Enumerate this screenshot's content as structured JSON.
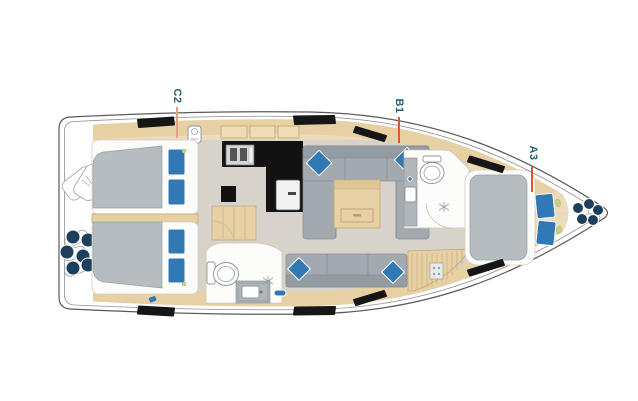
{
  "page": {
    "background": "#ffffff"
  },
  "labels": [
    {
      "text": "C2",
      "leader": "warm"
    },
    {
      "text": "B1",
      "leader": "red"
    },
    {
      "text": "A3",
      "leader": "red"
    }
  ],
  "icons": [
    "life-raft-icon",
    "stern-fenders-icon",
    "bow-fenders-icon",
    "stove-icon",
    "fridge-icon",
    "steps-icon",
    "toilet-icon",
    "sink-icon",
    "shower-icon",
    "table-icon",
    "deck-hatch-icon",
    "reading-light-icon"
  ],
  "colors": {
    "label_text": "#1f5e70",
    "leader_warm": "#e0a285",
    "leader_red": "#d8583a",
    "hull_line": "#5a5a5a",
    "wood_base": "#eddcbb",
    "wood_trim": "#e6d0a4",
    "wood_edge": "#c2a878",
    "floor_gray": "#d8d3ca",
    "upholstery_gray": "#a2aab0",
    "upholstery_dark": "#939ca3",
    "mattress_gray": "#b6bcbf",
    "pillow_blue": "#3079b4",
    "counter_black": "#121212",
    "fender_navy": "#1c3f5e",
    "accent_green": "#c6d289",
    "room_white": "#fcfcfa"
  }
}
